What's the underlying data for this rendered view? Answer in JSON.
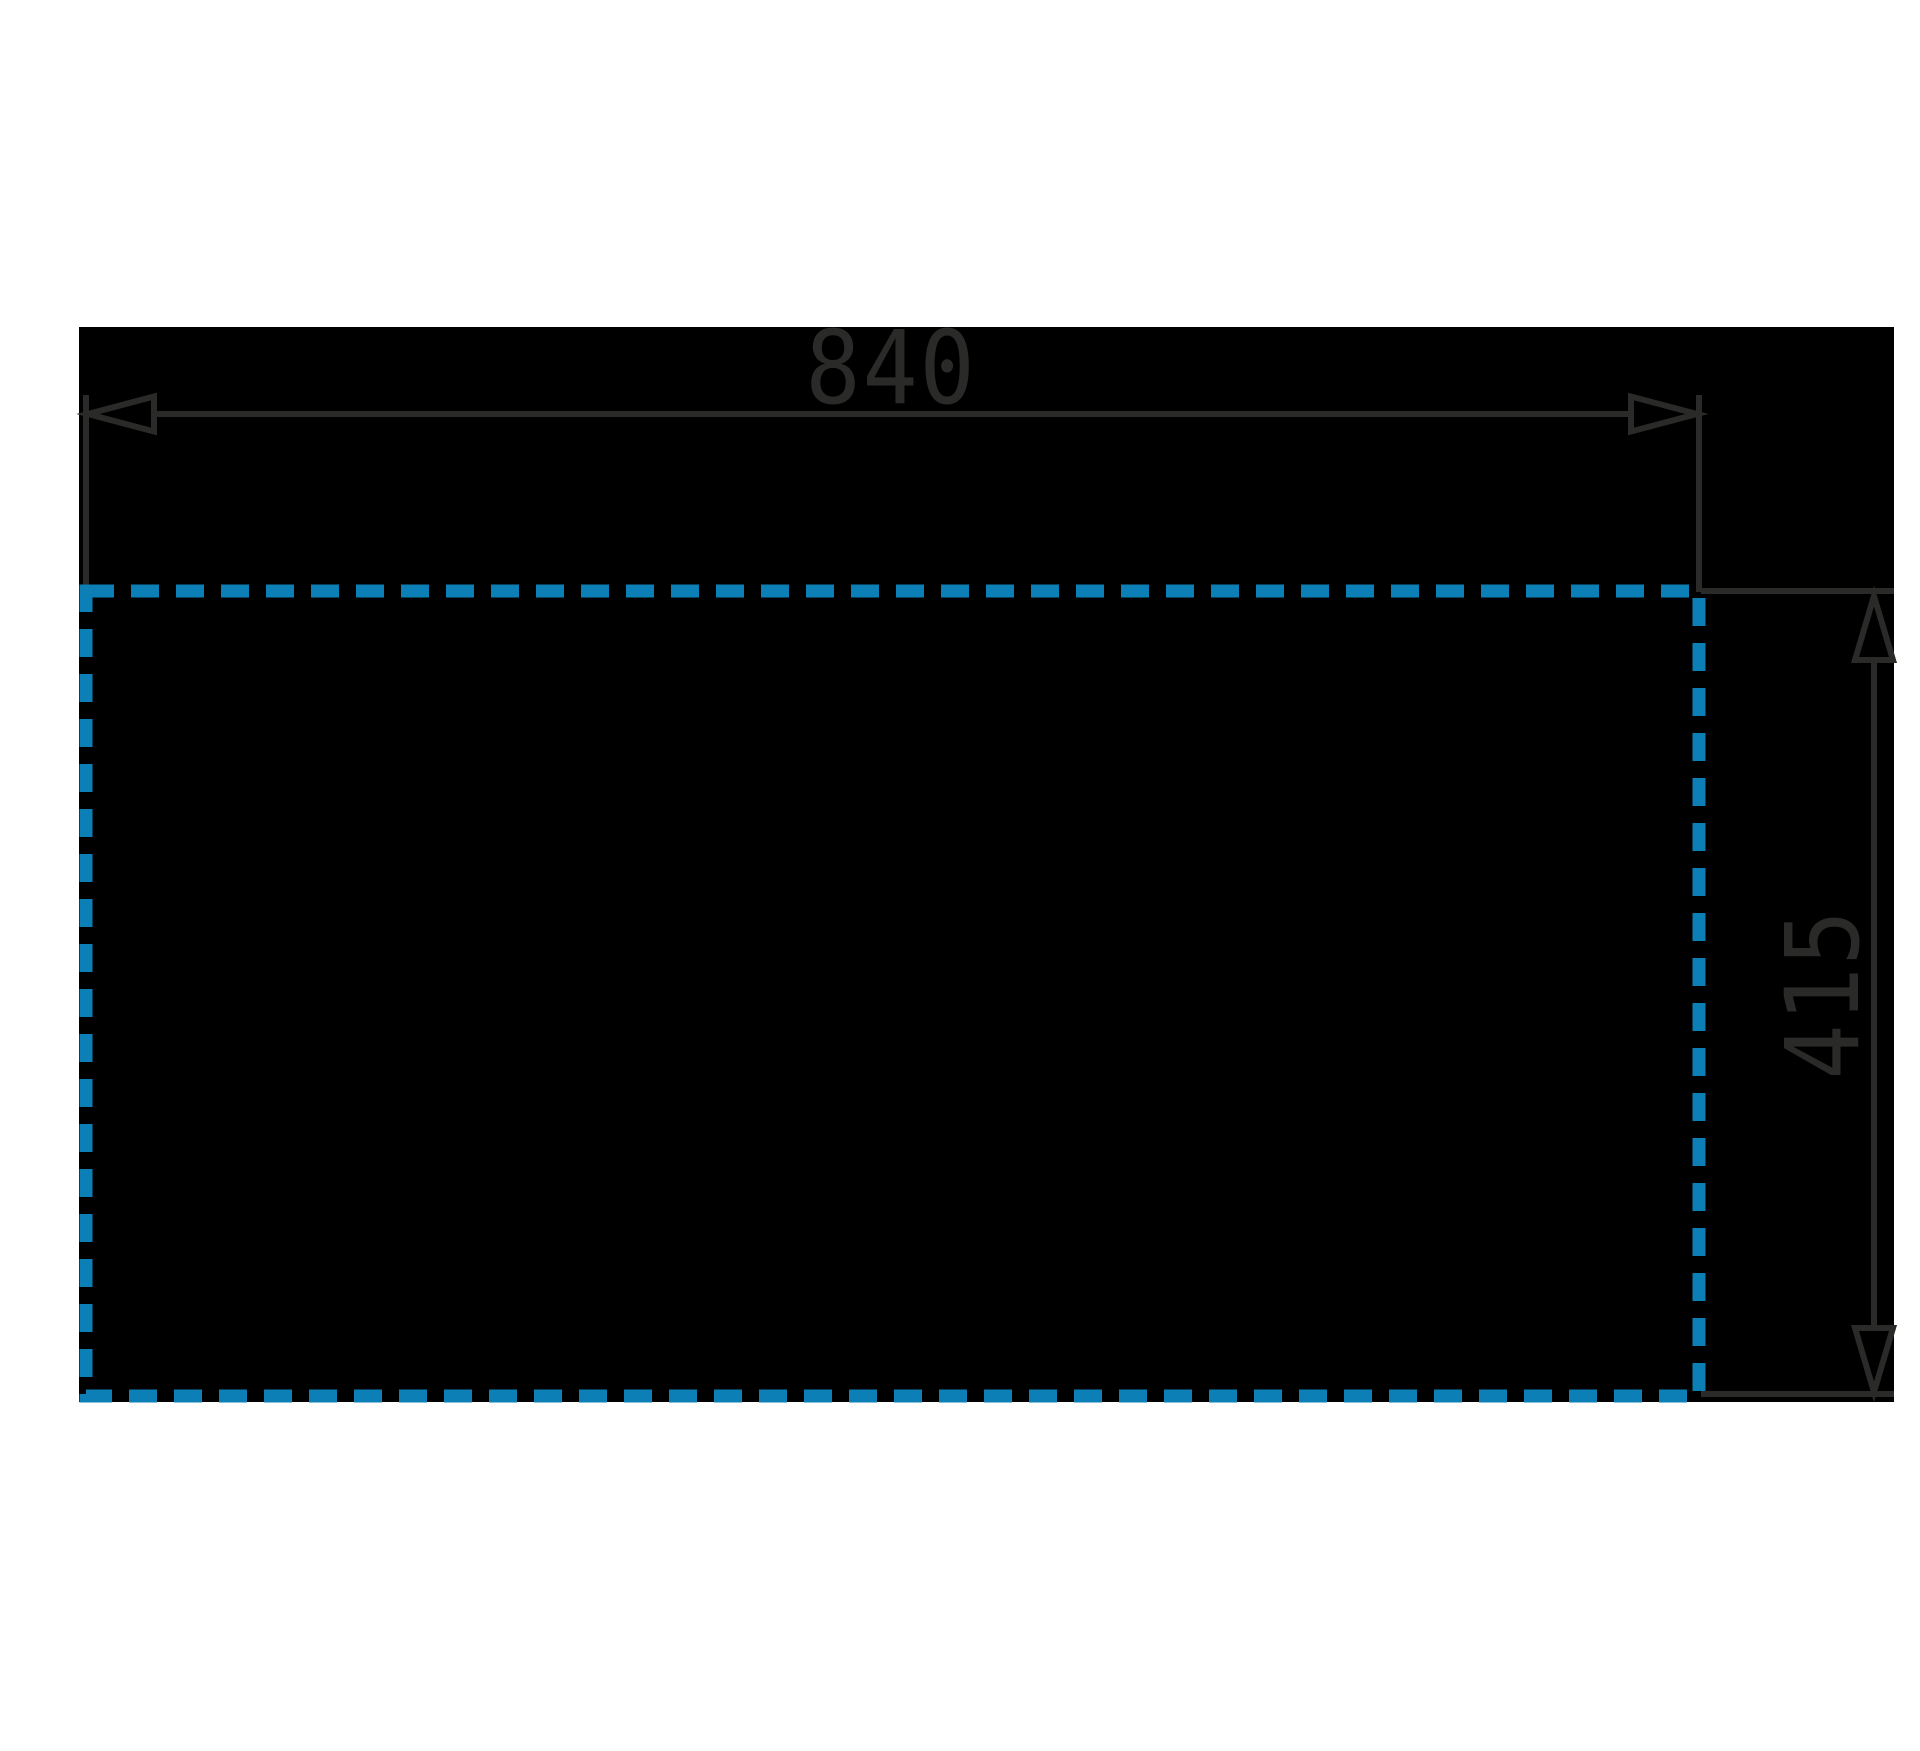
{
  "drawing": {
    "kind": "cutout-dimension-diagram",
    "labels": {
      "width": "840",
      "height": "415"
    },
    "colors": {
      "background": "#ffffff",
      "product": "#000000",
      "cutout_blue": "#0c80b6",
      "line": "#2a2a28"
    }
  }
}
